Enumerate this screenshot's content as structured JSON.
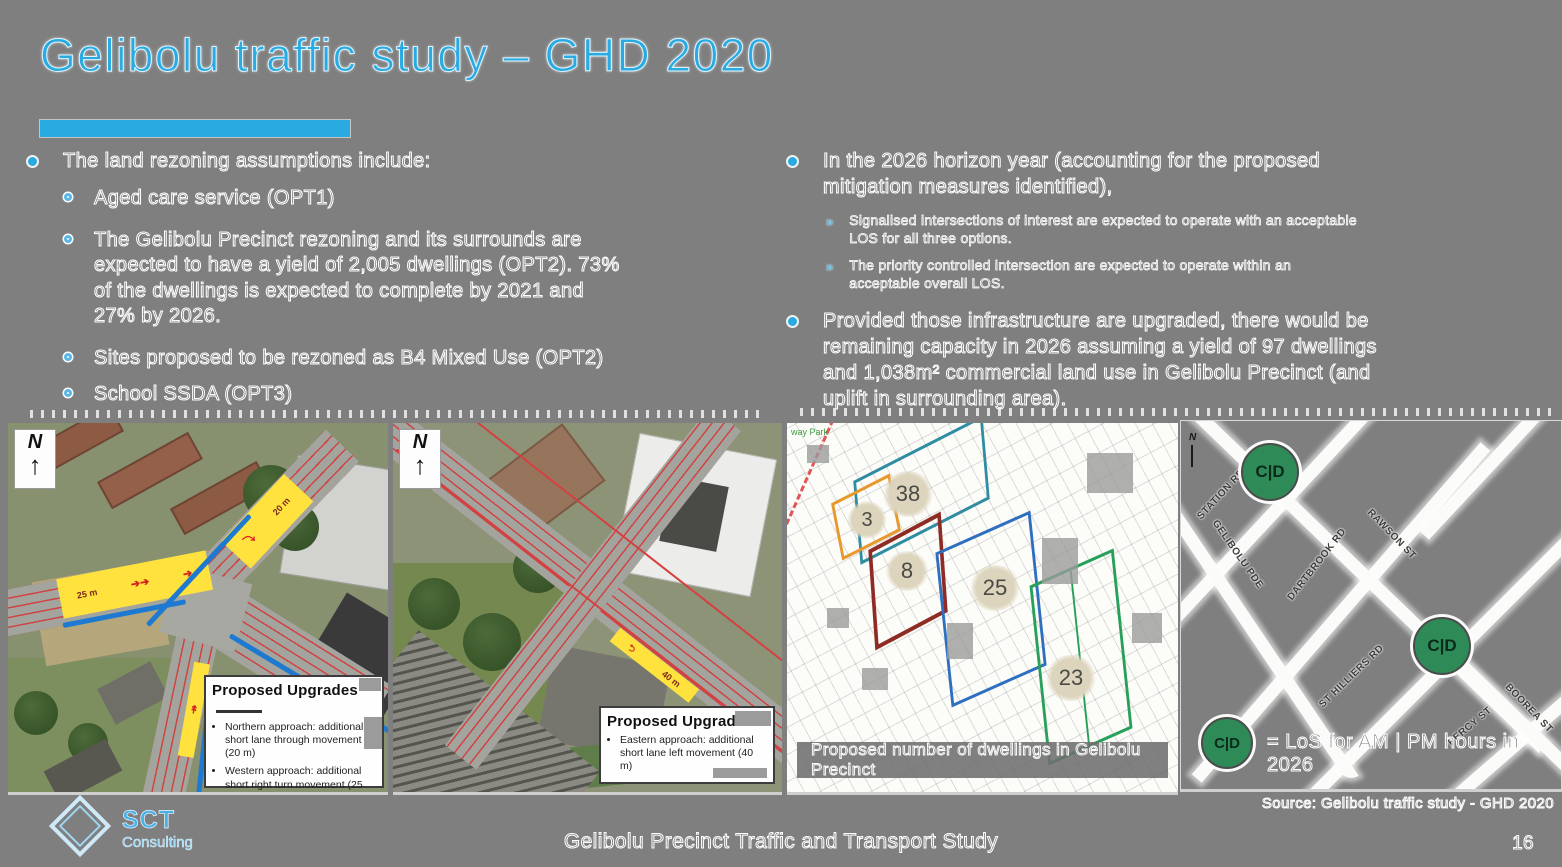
{
  "slide": {
    "title": "Gelibolu traffic study – GHD 2020",
    "accent_color": "#29abe2",
    "background_color": "#7f7f7f",
    "source_note": "Source: Gelibolu traffic study - GHD 2020",
    "footer": {
      "logo_text": "SCT",
      "logo_subtext": "Consulting",
      "study_title": "Gelibolu Precinct Traffic and Transport Study",
      "page_number": "16"
    }
  },
  "left_column": {
    "heading": "The land rezoning assumptions include:",
    "items": [
      "Aged care service (OPT1)",
      "The Gelibolu Precinct rezoning and its surrounds are\nexpected to have a yield of 2,005 dwellings (OPT2). 73%\nof the dwellings is expected to complete by 2021 and\n27% by 2026.",
      "Sites proposed to be rezoned as B4 Mixed Use (OPT2)",
      "School SSDA (OPT3)"
    ]
  },
  "right_column": {
    "bullet1": "In the 2026 horizon year (accounting for the proposed\nmitigation measures identified),",
    "bullet1_subs": [
      "Signalised intersections of interest are expected to operate with an acceptable\nLOS for all three options.",
      "The priority controlled intersection are expected to operate within an\nacceptable overall LOS."
    ],
    "bullet2": "Provided those infrastructure are upgraded, there would be\nremaining capacity in 2026 assuming a yield of 97 dwellings\nand 1,038m² commercial land use in Gelibolu Precinct (and\nuplift in surrounding area)."
  },
  "panel_upgrades_west": {
    "compass": "N",
    "box_title": "Proposed Upgrades",
    "items": [
      "Northern approach: additional short lane through movement (20 m)",
      "Western approach: additional short right turn movement (25 m)",
      "Southern approach: shared through and right from the kerb side short lane"
    ],
    "lane_labels": [
      "25 m",
      "20 m"
    ]
  },
  "panel_upgrade_east": {
    "compass": "N",
    "box_title": "Proposed Upgrade",
    "items": [
      "Eastern approach: additional short lane left movement (40 m)"
    ],
    "lane_labels": [
      "40 m"
    ]
  },
  "panel_dwellings": {
    "caption": "Proposed number of dwellings in Gelibolu Precinct",
    "park_label": "way Park",
    "zones": [
      {
        "dwellings": "38",
        "color": "#2f8ca3"
      },
      {
        "dwellings": "3",
        "color": "#e8992e"
      },
      {
        "dwellings": "8",
        "color": "#8f2b25"
      },
      {
        "dwellings": "25",
        "color": "#2f6fbf"
      },
      {
        "dwellings": "23",
        "color": "#27a05a"
      }
    ]
  },
  "panel_los": {
    "compass": "N",
    "marker_label": "C|D",
    "marker_color": "#2e8b57",
    "legend_text": "= LoS for AM | PM hours in 2026",
    "streets": [
      "STATION RD",
      "GELIBOLU PDE",
      "DARTBROOK RD",
      "RAWSON ST",
      "ST HILLIERS RD",
      "PERCY ST",
      "BOOREA ST"
    ]
  }
}
